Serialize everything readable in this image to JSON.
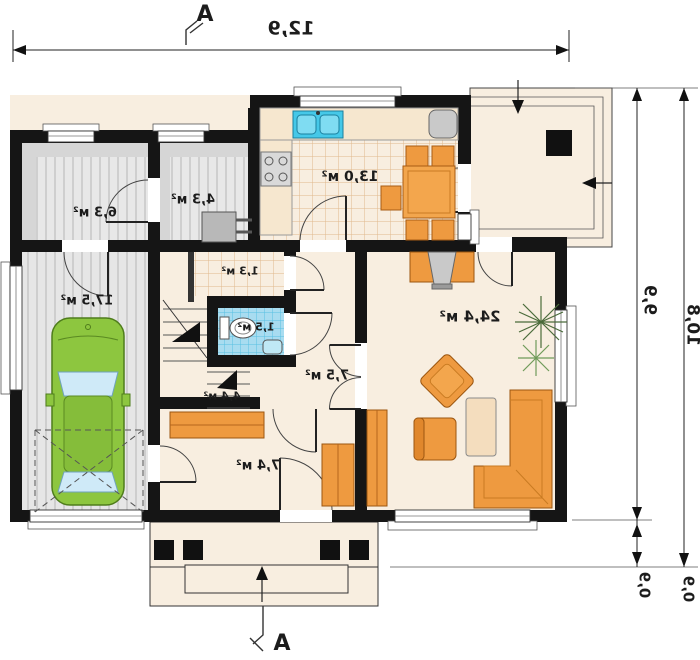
{
  "section_markers": {
    "top": "A",
    "bottom": "A"
  },
  "dimensions": {
    "total_width": "12,9",
    "right_inner": "9,9",
    "right_outer": "10,8",
    "right_inner_lower": "0,9",
    "right_outer_lower": "0,9"
  },
  "rooms": {
    "garage": {
      "area": "17,5 м²"
    },
    "utility": {
      "area": "6,3 м²"
    },
    "boiler": {
      "area": "4,3 м²"
    },
    "kitchen": {
      "area": "13,0 м²"
    },
    "pantry": {
      "area": "1,3 м²"
    },
    "wc": {
      "area": "1,5 м²"
    },
    "stairs": {
      "area": "4,4 м²"
    },
    "hall": {
      "area": "7,5 м²"
    },
    "entrance": {
      "area": "7,4 м²"
    },
    "living": {
      "area": "24,4 м²"
    }
  },
  "colors": {
    "wall": "#151515",
    "floor_beige": "#f8eee0",
    "tile_line": "#e0b88c",
    "gray_floor": "#d6d6d6",
    "wc_tile": "#a8dcf0",
    "furniture_orange": "#ee9a40",
    "car_green": "#8dc63f",
    "glass_blue": "#cfeaf8"
  }
}
